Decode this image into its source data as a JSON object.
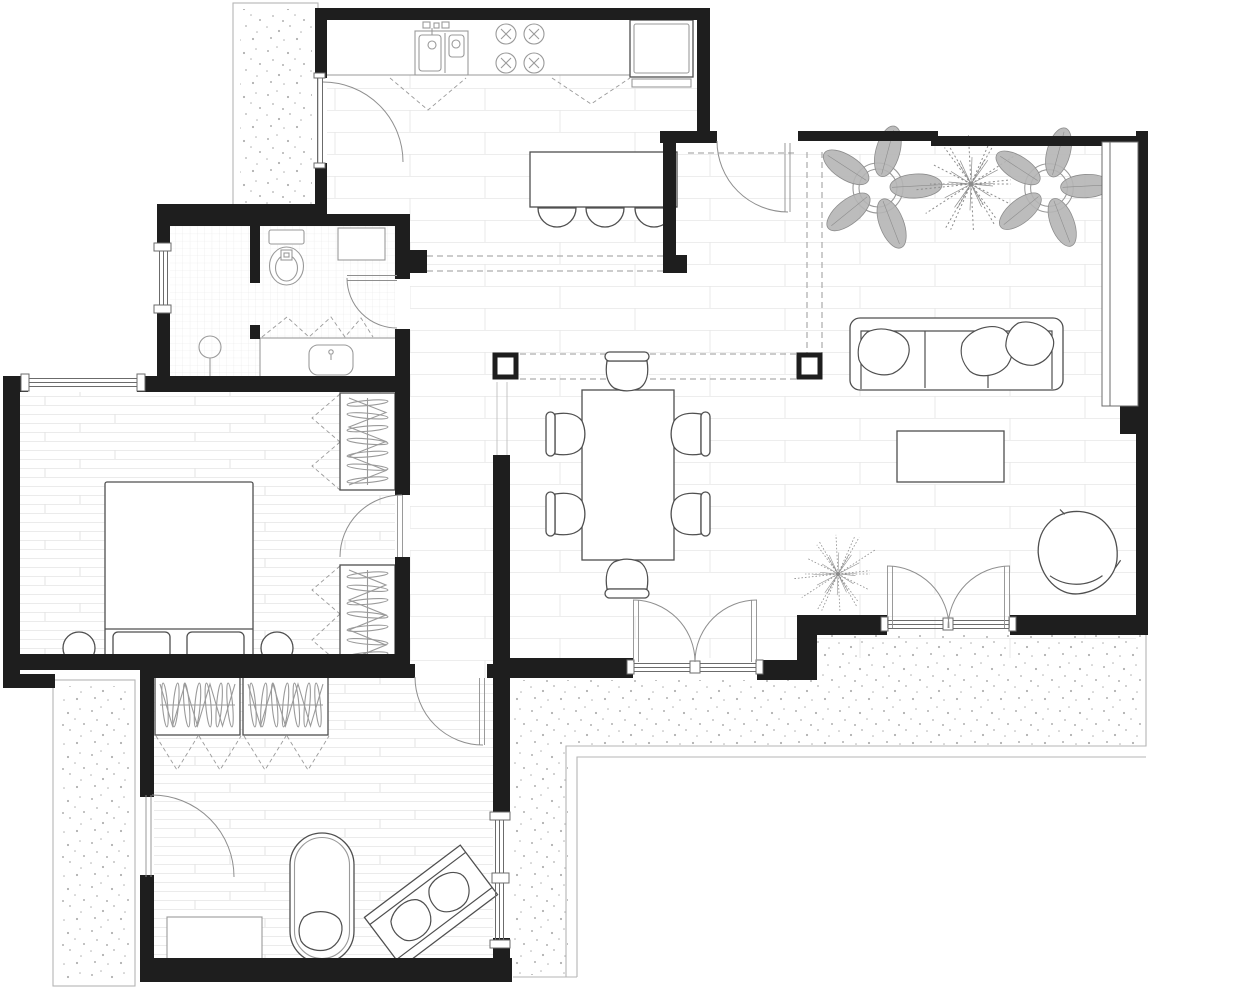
{
  "canvas": {
    "width": 1240,
    "height": 989,
    "background": "#ffffff"
  },
  "palette": {
    "wall": "#1e1e1e",
    "furniture_line": "#4f4f4f",
    "fixture_line": "#9a9a9a",
    "door_arc": "#8f8f8f",
    "window_line": "#6b6b6b",
    "dashed_line": "#9a9a9a",
    "railing": "#b5b5b5",
    "tile_line": "#ededed",
    "plank_line": "#ebebeb",
    "bath_grid_line": "#e7e7e7",
    "stipple_dot": "#b0b0b0",
    "plant_fill": "#b5b5b5",
    "plant_stroke": "#8c8c8c"
  },
  "legend": {
    "drawing_type": "apartment-floor-plan",
    "rooms": [
      {
        "name": "kitchen"
      },
      {
        "name": "entry-hall"
      },
      {
        "name": "living-dining-room"
      },
      {
        "name": "bathroom"
      },
      {
        "name": "bedroom"
      },
      {
        "name": "second-room"
      },
      {
        "name": "terrace-top-left"
      },
      {
        "name": "terrace-left"
      },
      {
        "name": "terrace-bottom-right"
      }
    ]
  },
  "plan": {
    "floors": {
      "tile": [
        [
          327,
          75,
          370,
          56
        ],
        [
          327,
          131,
          336,
          83
        ],
        [
          663,
          143,
          473,
          112
        ],
        [
          410,
          214,
          726,
          444
        ],
        [
          410,
          382,
          100,
          296
        ]
      ],
      "plank": [
        [
          20,
          392,
          375,
          262
        ],
        [
          154,
          678,
          339,
          284
        ]
      ],
      "bath": [
        [
          170,
          226,
          225,
          152
        ]
      ],
      "stipple_rects": [
        [
          240,
          9,
          72,
          196
        ],
        [
          61,
          686,
          69,
          293
        ]
      ],
      "stipple_path": "M513 680 L817 680 L817 635 L1146 635 L1146 748 L568 748 L568 975 L513 975 Z"
    },
    "walls": [
      [
        315,
        8,
        395,
        12,
        "kitchen-north-wall"
      ],
      [
        315,
        8,
        12,
        70,
        "kitchen-west-wall-upper"
      ],
      [
        315,
        163,
        12,
        51,
        "kitchen-west-wall-lower"
      ],
      [
        157,
        204,
        170,
        12,
        "terrace-band-wall"
      ],
      [
        157,
        214,
        253,
        12,
        "bathroom-north-wall"
      ],
      [
        157,
        226,
        13,
        25,
        "bathroom-west-wall-upper"
      ],
      [
        157,
        305,
        13,
        73,
        "bathroom-west-wall-lower"
      ],
      [
        3,
        376,
        25,
        16,
        "bedroom-north-wall-left"
      ],
      [
        137,
        376,
        273,
        16,
        "bedroom-north-wall-right"
      ],
      [
        3,
        376,
        17,
        312,
        "bedroom-west-wall"
      ],
      [
        3,
        654,
        407,
        16,
        "bedroom-south-wall"
      ],
      [
        3,
        674,
        52,
        14,
        "terrace-stub-wall"
      ],
      [
        140,
        664,
        275,
        14,
        "room2-north-wall-left"
      ],
      [
        487,
        664,
        23,
        14,
        "room2-north-wall-right"
      ],
      [
        140,
        664,
        14,
        133,
        "room2-west-wall-upper"
      ],
      [
        140,
        875,
        14,
        107,
        "room2-west-wall-lower"
      ],
      [
        140,
        958,
        372,
        24,
        "room2-south-wall"
      ],
      [
        493,
        455,
        17,
        365,
        "east-partition-wall"
      ],
      [
        493,
        938,
        17,
        44,
        "east-partition-wall-lower"
      ],
      [
        395,
        226,
        15,
        53,
        "bathroom-east-wall-upper"
      ],
      [
        395,
        329,
        15,
        47,
        "bathroom-east-wall-lower"
      ],
      [
        410,
        250,
        17,
        23,
        "hall-nib-wall"
      ],
      [
        395,
        392,
        15,
        103,
        "bedroom-east-wall-upper"
      ],
      [
        395,
        557,
        15,
        97,
        "bedroom-east-wall-lower"
      ],
      [
        510,
        658,
        123,
        20,
        "living-south-wall-left"
      ],
      [
        757,
        660,
        60,
        20,
        "living-south-wall-mid"
      ],
      [
        797,
        635,
        20,
        45,
        "living-south-wall-jog"
      ],
      [
        797,
        615,
        90,
        20,
        "living-south-wall-right1"
      ],
      [
        1010,
        615,
        137,
        20,
        "living-south-wall-right2"
      ],
      [
        1136,
        131,
        12,
        504,
        "living-east-wall"
      ],
      [
        1120,
        406,
        16,
        28,
        "east-wall-notch"
      ],
      [
        798,
        131,
        140,
        10,
        "top-wall-left"
      ],
      [
        931,
        136,
        207,
        10,
        "top-wall-right"
      ],
      [
        660,
        131,
        57,
        12,
        "entry-kitchen-wall"
      ],
      [
        697,
        8,
        13,
        125,
        "kitchen-east-wall-upper"
      ],
      [
        663,
        143,
        13,
        112,
        "kitchen-east-wall-inner"
      ],
      [
        663,
        255,
        24,
        18,
        "kitchen-wall-foot"
      ],
      [
        250,
        226,
        10,
        57,
        "bath-partition-upper"
      ],
      [
        250,
        325,
        10,
        14,
        "bath-partition-lower"
      ]
    ],
    "columns": [
      [
        495,
        355,
        21,
        22
      ],
      [
        799,
        355,
        21,
        22
      ]
    ],
    "railings": {
      "rects": [
        [
          233,
          3,
          85,
          209
        ],
        [
          53,
          680,
          82,
          306
        ]
      ],
      "paths": [
        "M566 977 L566 746 L1146 746 L1146 632",
        "M577 977 L577 757 L1146 757",
        "M513 977 L577 977"
      ]
    },
    "dashed_lines": [
      [
        427,
        256,
        663,
        256
      ],
      [
        427,
        271,
        663,
        271
      ],
      [
        807,
        152,
        807,
        353
      ],
      [
        822,
        152,
        822,
        353
      ],
      [
        520,
        354,
        797,
        354
      ],
      [
        520,
        379,
        797,
        379
      ],
      [
        688,
        153,
        798,
        153
      ]
    ],
    "dashed_paths": [
      "M390 78 L428 110 L466 78",
      "M552 78 L591 104 L630 78",
      "M262 337 L287 317 L309 337 L331 317 L345 337 L361 318 L373 337",
      "M340 394 L312 418 L340 442",
      "M340 442 L312 466 L340 490",
      "M340 566 L312 590 L340 614",
      "M340 614 L312 640 L340 664",
      "M156 736 L177 770 L198 736",
      "M199 736 L220 770 L241 736",
      "M244 736 L265 770 L286 736",
      "M287 736 L308 770 L329 736"
    ],
    "glass_lines": [
      [
        497,
        382,
        497,
        455
      ],
      [
        507,
        382,
        507,
        455
      ]
    ]
  },
  "symbols": {
    "plants": [
      {
        "type": "palm",
        "cx": 878,
        "cy": 188,
        "s": 1
      },
      {
        "type": "fern",
        "cx": 971,
        "cy": 184,
        "s": 1
      },
      {
        "type": "palm",
        "cx": 1049,
        "cy": 188,
        "s": 0.97
      },
      {
        "type": "fern",
        "cx": 838,
        "cy": 574,
        "s": 0.8
      }
    ],
    "dining_chairs": [
      {
        "cx": 627,
        "cy": 372,
        "rot": 0
      },
      {
        "cx": 627,
        "cy": 578,
        "rot": 180
      },
      {
        "cx": 566,
        "cy": 434,
        "rot": -90
      },
      {
        "cx": 566,
        "cy": 514,
        "rot": -90
      },
      {
        "cx": 690,
        "cy": 434,
        "rot": 90
      },
      {
        "cx": 690,
        "cy": 514,
        "rot": 90
      }
    ],
    "island_stools": [
      {
        "cx": 557,
        "cy": 208
      },
      {
        "cx": 605,
        "cy": 208
      },
      {
        "cx": 654,
        "cy": 208
      }
    ],
    "burners": [
      {
        "cx": 506,
        "cy": 34
      },
      {
        "cx": 534,
        "cy": 34
      },
      {
        "cx": 506,
        "cy": 63
      },
      {
        "cx": 534,
        "cy": 63
      }
    ],
    "wardrobes": [
      {
        "x": 340,
        "y": 393,
        "w": 55,
        "h": 97,
        "orient": "v",
        "name": "bedroom-wardrobe-north"
      },
      {
        "x": 340,
        "y": 565,
        "w": 55,
        "h": 100,
        "orient": "v",
        "name": "bedroom-wardrobe-south"
      },
      {
        "x": 155,
        "y": 675,
        "w": 85,
        "h": 60,
        "orient": "h",
        "name": "room2-wardrobe-left"
      },
      {
        "x": 243,
        "y": 675,
        "w": 85,
        "h": 60,
        "orient": "h",
        "name": "room2-wardrobe-right"
      }
    ],
    "pillows": [
      {
        "cx": 884,
        "cy": 352,
        "s": 27,
        "rot": 18,
        "name": "sofa-cushion-left"
      },
      {
        "cx": 988,
        "cy": 351,
        "s": 28,
        "rot": -14,
        "name": "sofa-cushion-right1"
      },
      {
        "cx": 1030,
        "cy": 344,
        "s": 25,
        "rot": 30,
        "name": "sofa-cushion-right2"
      },
      {
        "cx": 321,
        "cy": 931,
        "s": 23,
        "rot": 8,
        "name": "daybed-cushion"
      },
      {
        "cx": 412,
        "cy": 920,
        "s": 22,
        "rot": -35,
        "name": "bench-cushion-left"
      },
      {
        "cx": 450,
        "cy": 892,
        "s": 22,
        "rot": -20,
        "name": "bench-cushion-right"
      }
    ],
    "bed_pillows": [
      [
        113,
        632,
        57,
        27
      ],
      [
        187,
        632,
        57,
        27
      ]
    ],
    "nightstands": [
      {
        "cx": 79,
        "cy": 648,
        "r": 16
      },
      {
        "cx": 277,
        "cy": 648,
        "r": 16
      }
    ]
  }
}
